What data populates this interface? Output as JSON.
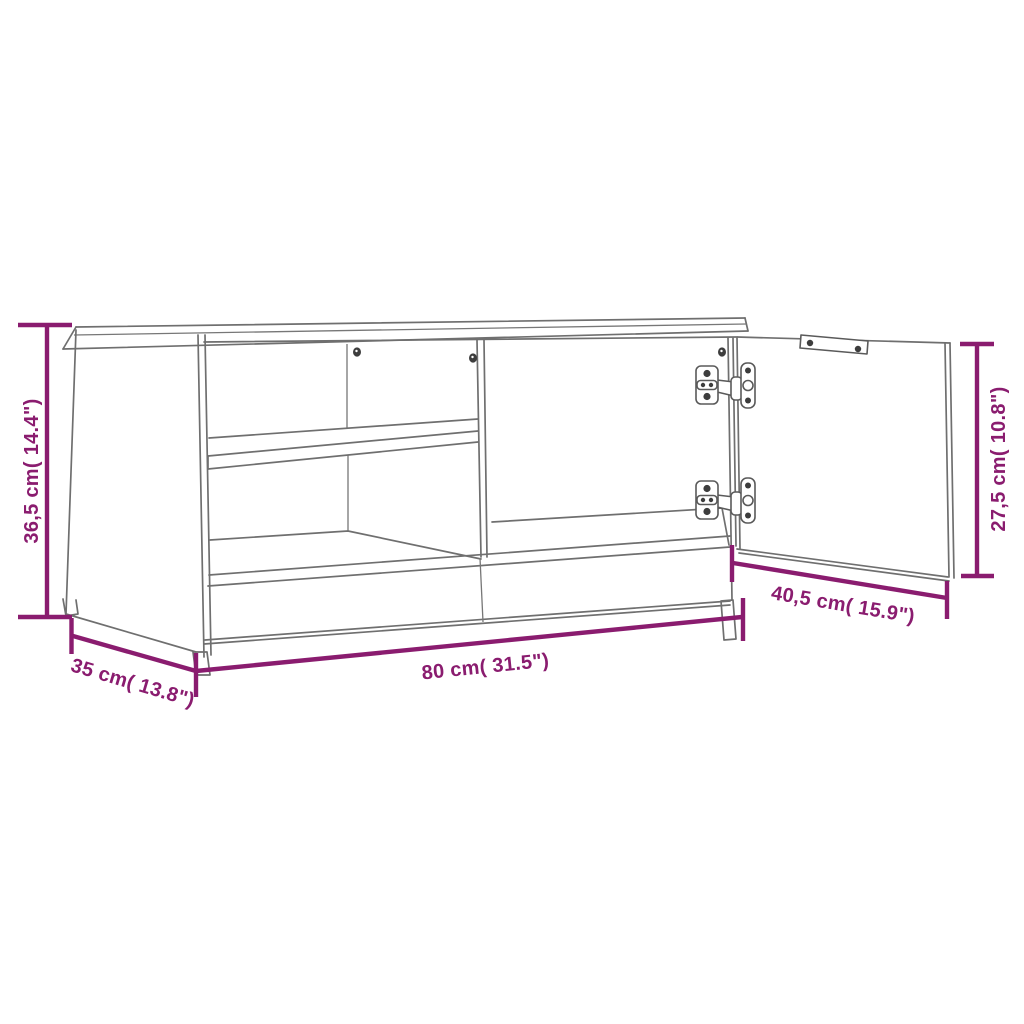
{
  "page": {
    "background": "#ffffff"
  },
  "diagram": {
    "subject": "tv-cabinet-dimension-drawing",
    "colors": {
      "dimension_accent": "#8a1c6f",
      "drawing_outline": "#6f6f6f"
    },
    "dimensions": {
      "height": {
        "label": "36,5 cm( 14.4\")",
        "cm": "36,5",
        "inches": "14.4"
      },
      "depth": {
        "label": "35 cm( 13.8\")",
        "cm": "35",
        "inches": "13.8"
      },
      "width": {
        "label": "80 cm( 31.5\")",
        "cm": "80",
        "inches": "31.5"
      },
      "door_width": {
        "label": "40,5 cm( 15.9\")",
        "cm": "40,5",
        "inches": "15.9"
      },
      "door_height": {
        "label": "27,5 cm( 10.8\")",
        "cm": "27,5",
        "inches": "10.8"
      }
    }
  }
}
